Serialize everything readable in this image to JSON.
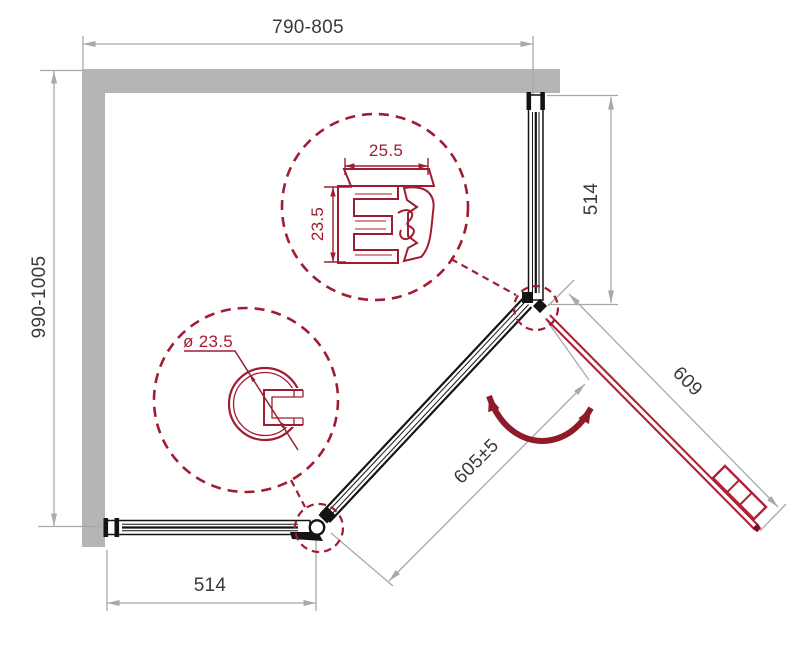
{
  "drawing": {
    "title": "Shower enclosure dimensional drawing (top view)",
    "dimensions": {
      "top_width": "790-805",
      "left_depth": "990-1005",
      "right_panel": "514",
      "bottom_panel": "514",
      "door_width": "609",
      "entry_width": "605±5"
    },
    "profile_details": {
      "wall_profile_width": "25.5",
      "wall_profile_depth": "23.5",
      "pivot_profile_diameter": "ø 23.5"
    },
    "colors": {
      "wall_gray": "#b5b5b6",
      "dimension_gray": "#a7a9ab",
      "text_dark": "#3a3a3a",
      "detail_maroon": "#9f1d31",
      "door_red": "#ae2138",
      "swing_arrow_red": "#8e1a2a",
      "line_black": "#141414"
    }
  }
}
